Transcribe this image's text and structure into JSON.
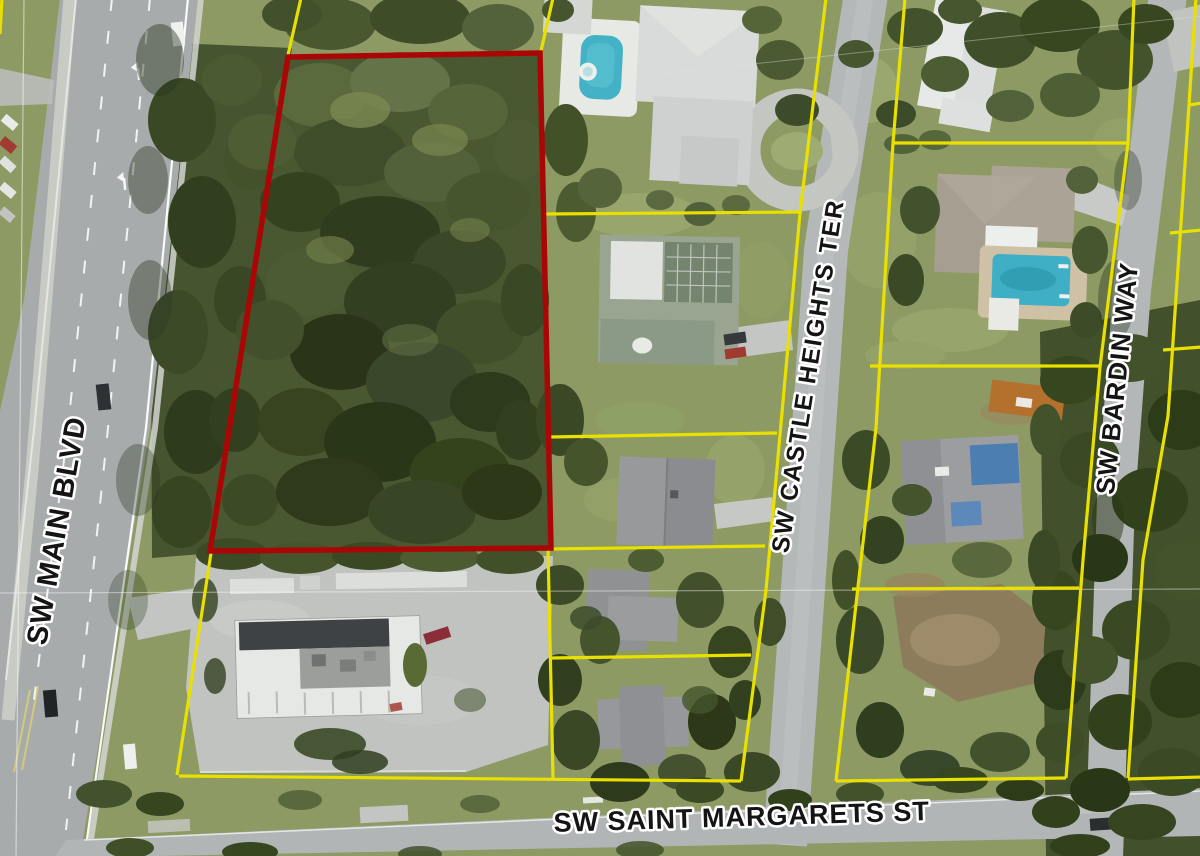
{
  "map": {
    "street_labels": {
      "main_blvd": "SW MAIN BLVD",
      "castle_heights_ter": "SW CASTLE HEIGHTS TER",
      "bardin_way": "SW BARDIN WAY",
      "saint_margarets_st": "SW SAINT MARGARETS ST"
    },
    "overlay_colors": {
      "subject_parcel": "#ab0606",
      "parcel_lines": "#e9e000",
      "label_fill": "#141414",
      "label_halo": "#ffffff",
      "pool_water": "#43b2c6"
    }
  }
}
